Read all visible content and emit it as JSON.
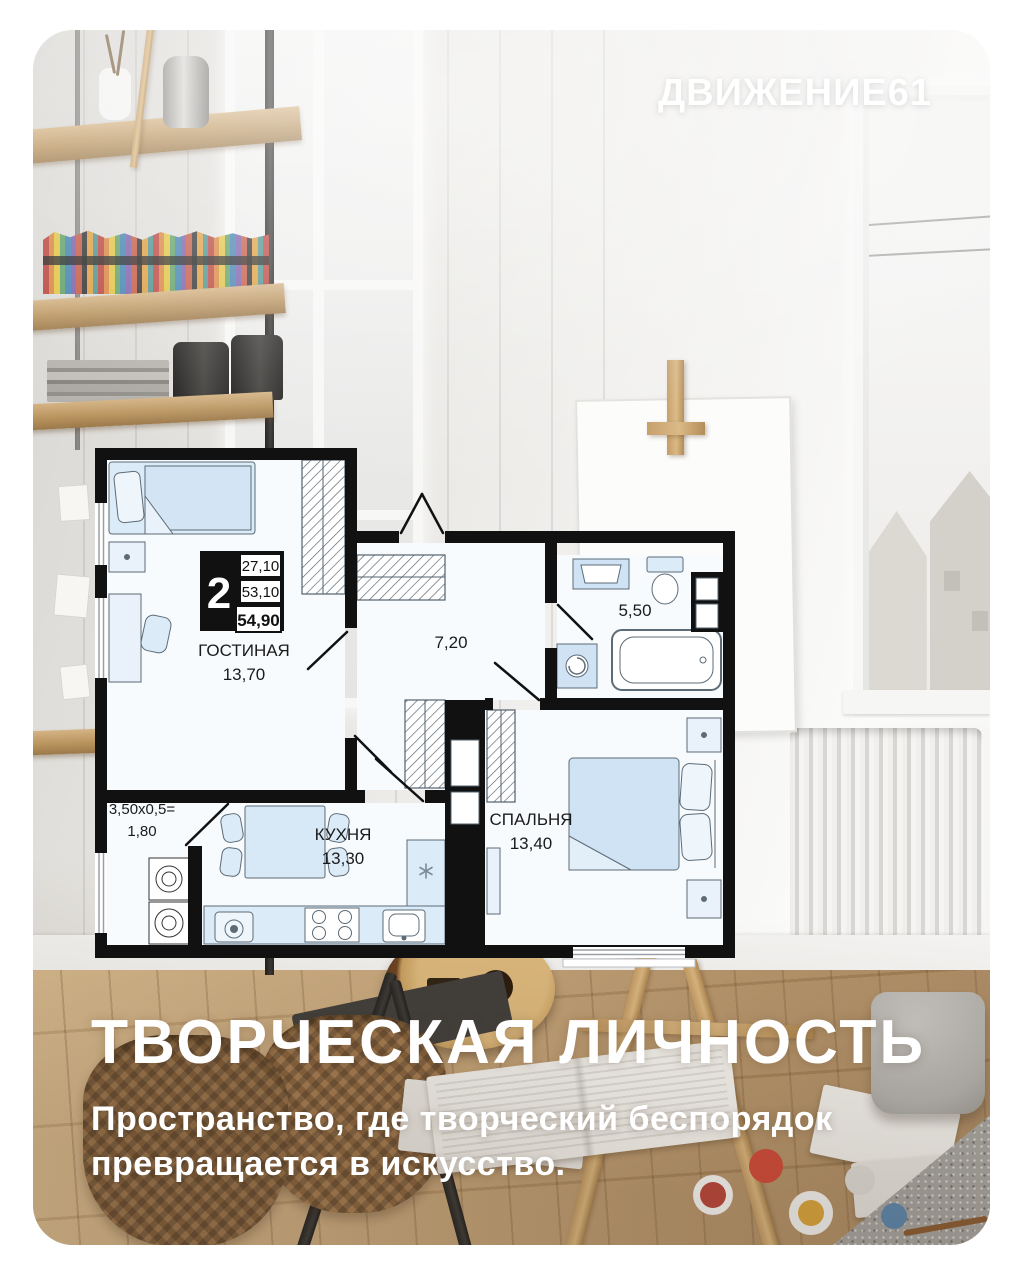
{
  "brand": {
    "logo": "ДВИЖЕНИЕ61"
  },
  "headline": {
    "title": "ТВОРЧЕСКАЯ ЛИЧНОСТЬ",
    "subtitle_line1": "Пространство, где творческий беспорядок",
    "subtitle_line2": "превращается в искусство."
  },
  "plan": {
    "rooms_count": "2",
    "area_living_sum": "27,10",
    "area_without_balcony": "53,10",
    "area_total": "54,90",
    "living": {
      "name": "ГОСТИНАЯ",
      "area": "13,70"
    },
    "kitchen": {
      "name": "КУХНЯ",
      "area": "13,30"
    },
    "bedroom": {
      "name": "СПАЛЬНЯ",
      "area": "13,40"
    },
    "hallway": {
      "area": "7,20"
    },
    "bathroom": {
      "area": "5,50"
    },
    "balcony": {
      "formula": "3,50x0,5=",
      "area": "1,80"
    }
  },
  "colors": {
    "card_background": "#ffffff",
    "plan_walls": "#111111",
    "plan_furniture": "#d7e8f6",
    "headline_text": "#ffffff"
  }
}
